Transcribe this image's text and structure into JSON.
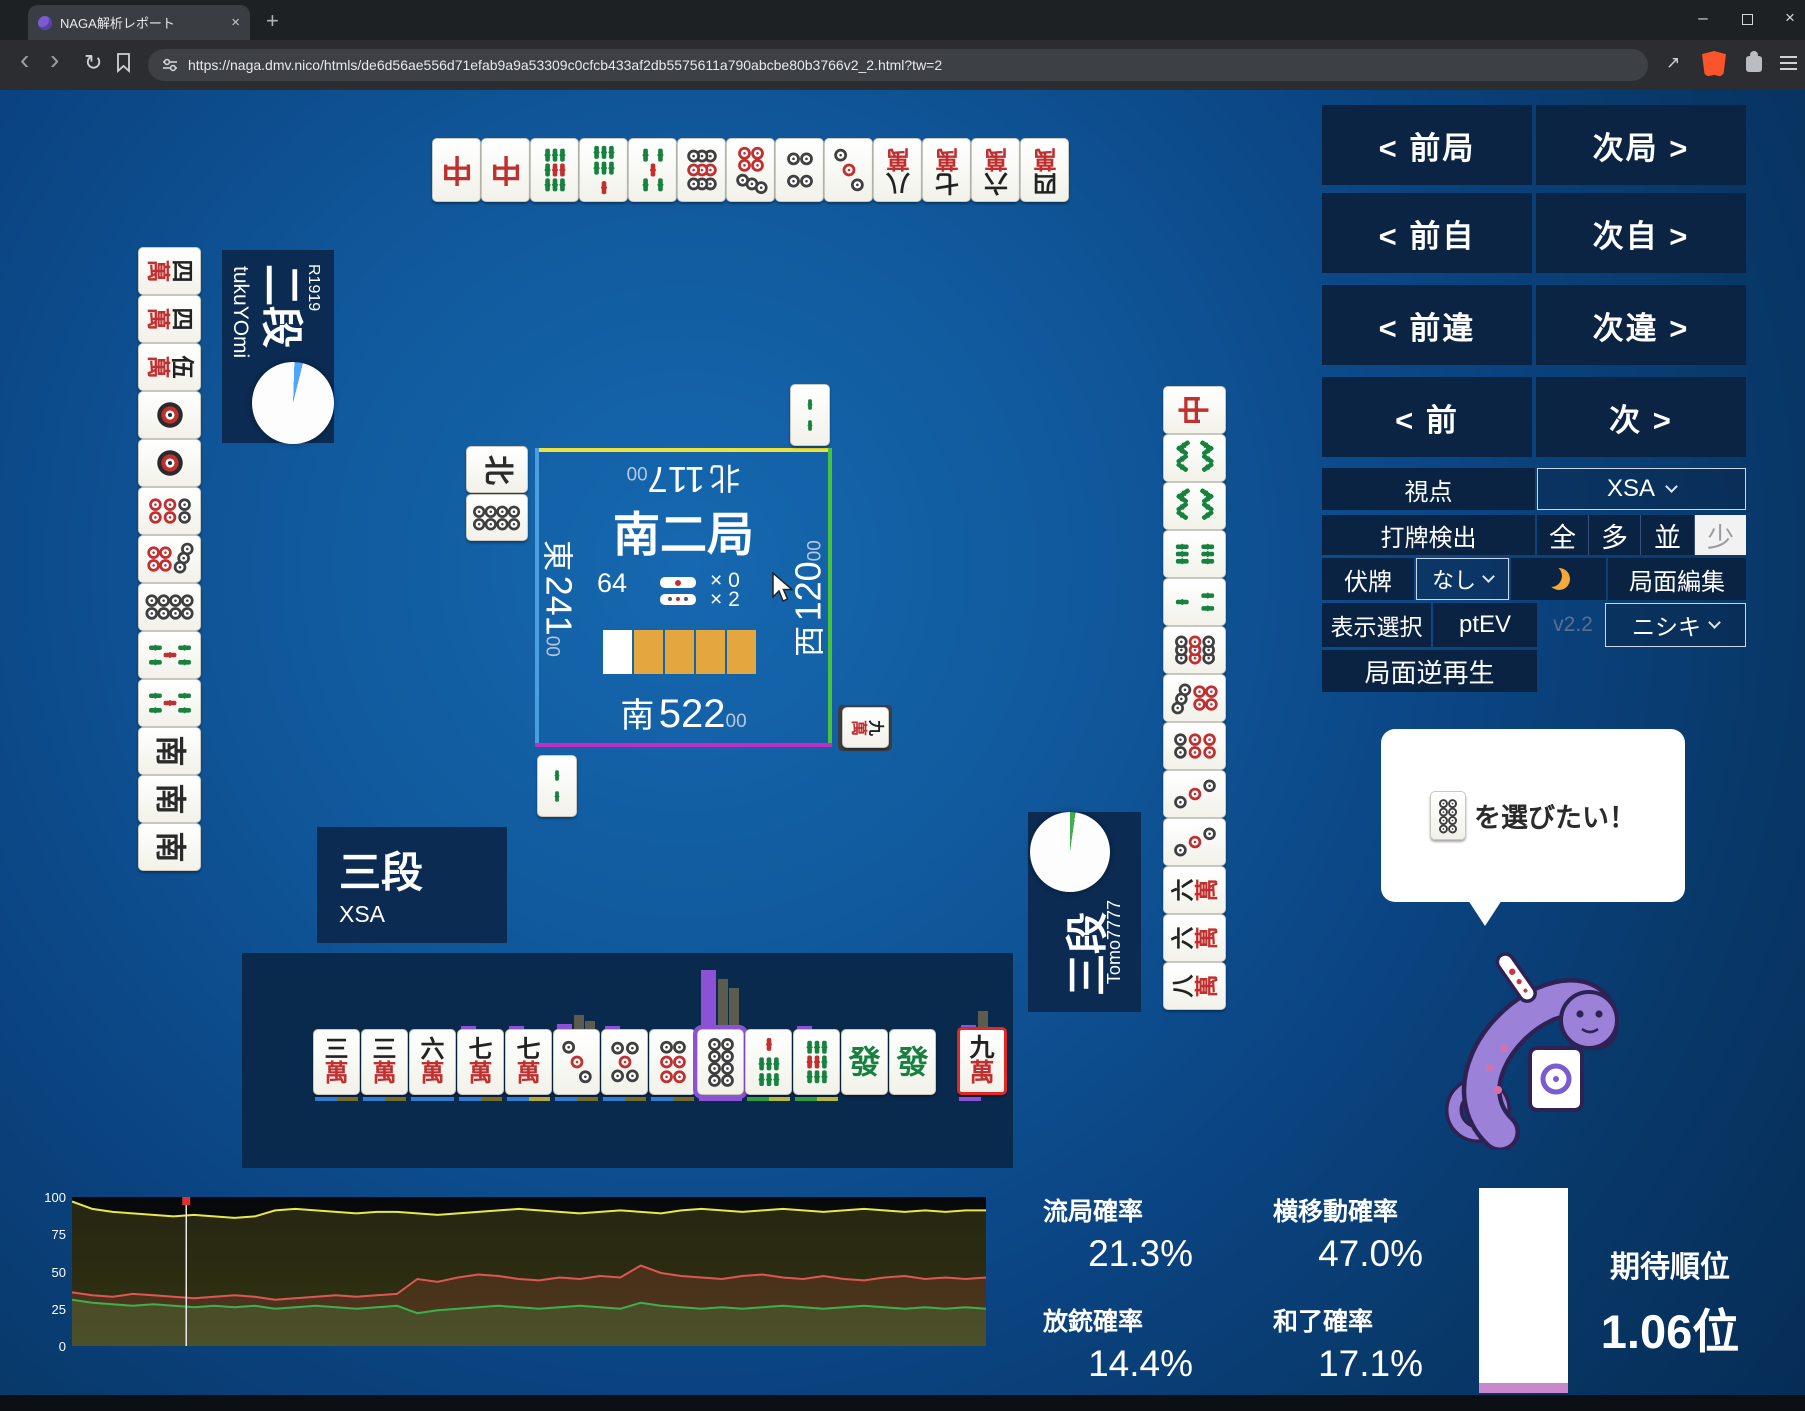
{
  "browser": {
    "tab_title": "NAGA解析レポート",
    "url": "https://naga.dmv.nico/htmls/de6d56ae556d71efab9a9a53309c0cfcb433af2db5575611a790abcbe80b3766v2_2.html?tw=2",
    "icons": {
      "close": "×",
      "plus": "+",
      "back": "‹",
      "forward": "›",
      "reload": "↻",
      "share": "↗",
      "minimize": "–"
    }
  },
  "nav": {
    "rows": [
      {
        "left": "< 前局",
        "right": "次局 >"
      },
      {
        "left": "< 前自",
        "right": "次自 >"
      },
      {
        "left": "< 前違",
        "right": "次違 >"
      },
      {
        "left": "< 前",
        "right": "次 >"
      }
    ]
  },
  "controls": {
    "viewpoint_label": "視点",
    "viewpoint_value": "XSA",
    "dahai_label": "打牌検出",
    "dahai_options": [
      "全",
      "多",
      "並",
      "少"
    ],
    "dahai_selected": "少",
    "fusehai_label": "伏牌",
    "fusehai_value": "なし",
    "kyokumen_edit": "局面編集",
    "display_select": "表示選択",
    "ptev": "ptEV",
    "version": "v2.2",
    "model_value": "ニシキ",
    "reverse_play": "局面逆再生"
  },
  "board": {
    "round": "南二局",
    "wall_count": "64",
    "riichi_sticks": "× 0",
    "honba_sticks": "× 2",
    "marker_colors": [
      "#ffffff",
      "#e4a63e",
      "#e4a63e",
      "#e4a63e",
      "#e4a63e"
    ],
    "edge_colors": {
      "top": "#efe23c",
      "left": "#4b9fe0",
      "right": "#46c43e",
      "bottom": "#c32cc3"
    },
    "seats": {
      "top": {
        "wind": "北",
        "score": "117",
        "sub": "00"
      },
      "left": {
        "wind": "東",
        "score": "241",
        "sub": "00"
      },
      "right": {
        "wind": "西",
        "score": "120",
        "sub": "00"
      },
      "bottom": {
        "wind": "南",
        "score": "522",
        "sub": "00"
      }
    }
  },
  "players": {
    "left": {
      "rank": "二段",
      "name": "tukuYOmi",
      "rating": "R1919",
      "pie": {
        "slice_color": "#4da6ff",
        "slice_deg": 12,
        "start_deg": 2
      }
    },
    "bottom": {
      "rank": "三段",
      "name": "XSA"
    },
    "right": {
      "rank": "三段",
      "name": "Tomo7777",
      "pie": {
        "slice_color": "#3fae4f",
        "slice_deg": 8,
        "start_deg": 0
      }
    }
  },
  "tiles": {
    "top_discards": [
      "chun",
      "chun",
      "9s",
      "7s",
      "5s",
      "9p",
      "7p",
      "4p",
      "3p",
      "8m",
      "7m",
      "6m",
      "4m"
    ],
    "left_discards": [
      "4m",
      "4m",
      "5m",
      "1p",
      "1p",
      "6p",
      "7p",
      "8p",
      "5s",
      "5s",
      "nan",
      "nan",
      "nan"
    ],
    "right_discards": [
      "chun",
      "8s",
      "8s",
      "6s",
      "3s",
      "9p",
      "7p",
      "6p",
      "3p",
      "3p",
      "6m",
      "6m",
      "8m"
    ],
    "hand": [
      "3m",
      "3m",
      "6m",
      "7m",
      "7m",
      "3p",
      "5p",
      "6p",
      "8p",
      "7s",
      "9s",
      "hatsu",
      "hatsu"
    ],
    "drawn": "9m",
    "selected_index": 8,
    "float_top": "2s",
    "float_left": [
      "pei",
      "8p"
    ],
    "float_bottom": "2s",
    "float_right": "9m"
  },
  "hand_analysis": {
    "bars": [
      {
        "tile": 3,
        "purple": 3,
        "grays": []
      },
      {
        "tile": 4,
        "purple": 3,
        "grays": []
      },
      {
        "tile": 5,
        "purple": 5,
        "grays": [
          14,
          8
        ]
      },
      {
        "tile": 6,
        "purple": 3,
        "grays": []
      },
      {
        "tile": 8,
        "purple": 59,
        "grays": [
          50,
          41
        ]
      },
      {
        "tile": 10,
        "purple": 3,
        "grays": []
      },
      {
        "tile": 13,
        "purple": 4,
        "grays": [
          18
        ]
      }
    ],
    "underlines": [
      [
        "#2e7bd4",
        "#756d28"
      ],
      [
        "#2e7bd4",
        "#756d28"
      ],
      [
        "#2e7bd4",
        "#2e7bd4"
      ],
      [
        "#2e7bd4",
        "#756d28"
      ],
      [
        "#2e7bd4",
        "#b7a93a"
      ],
      [
        "#2e7bd4",
        "#756d28"
      ],
      [
        "#2e7bd4",
        "#756d28"
      ],
      [
        "#2e7bd4",
        "#756d28"
      ],
      [
        "#8b52d6",
        "#8b52d6"
      ],
      [
        "#2f9e44",
        "#b7b73a"
      ],
      [
        "#2f9e44",
        "#b7b73a"
      ],
      [],
      [],
      [
        "#8b52d6"
      ]
    ]
  },
  "bubble": {
    "tile": "8p",
    "text": "を選びたい！"
  },
  "stats": {
    "ryuukyoku_label": "流局確率",
    "ryuukyoku": "21.3%",
    "houjuu_label": "放銃確率",
    "houjuu": "14.4%",
    "yokoidou_label": "横移動確率",
    "yokoidou": "47.0%",
    "houra_label": "和了確率",
    "houra": "17.1%"
  },
  "rank": {
    "label": "期待順位",
    "value": "1.06位",
    "bar_color": "#ffffff",
    "accent_color": "#c988cc",
    "accent_height": 10
  },
  "chart_data": {
    "type": "line",
    "title": "",
    "xlabel": "",
    "ylabel": "",
    "ylim": [
      0,
      100
    ],
    "yticks": [
      100,
      75,
      50,
      25,
      0
    ],
    "grid": false,
    "legend": "none",
    "cursor_x_fraction": 0.125,
    "series": [
      {
        "name": "yellow",
        "color": "#e8e84a",
        "fill": "rgba(210,200,70,0.16)",
        "values": [
          97,
          92,
          90,
          89,
          88,
          87,
          88,
          87,
          86,
          87,
          91,
          92,
          91,
          90,
          89,
          90,
          90,
          89,
          88,
          89,
          90,
          91,
          92,
          91,
          90,
          89,
          90,
          91,
          90,
          89,
          91,
          92,
          91,
          90,
          91,
          92,
          91,
          90,
          91,
          92,
          91,
          90,
          91,
          90,
          91,
          91
        ]
      },
      {
        "name": "red",
        "color": "#e05555",
        "fill": "rgba(200,80,70,0.18)",
        "values": [
          36,
          34,
          33,
          35,
          34,
          33,
          32,
          33,
          34,
          33,
          31,
          32,
          33,
          34,
          33,
          34,
          35,
          45,
          43,
          46,
          48,
          47,
          45,
          44,
          46,
          45,
          47,
          46,
          54,
          49,
          47,
          46,
          45,
          47,
          48,
          46,
          45,
          47,
          45,
          44,
          46,
          47,
          45,
          46,
          45,
          46
        ]
      },
      {
        "name": "green",
        "color": "#3fae4f",
        "fill": "rgba(70,170,90,0.20)",
        "values": [
          31,
          29,
          28,
          27,
          28,
          27,
          26,
          27,
          26,
          27,
          25,
          26,
          27,
          26,
          25,
          26,
          27,
          22,
          24,
          25,
          26,
          27,
          26,
          25,
          26,
          27,
          26,
          25,
          29,
          27,
          26,
          25,
          26,
          25,
          26,
          27,
          26,
          25,
          26,
          27,
          26,
          25,
          26,
          25,
          26,
          25
        ]
      }
    ]
  }
}
